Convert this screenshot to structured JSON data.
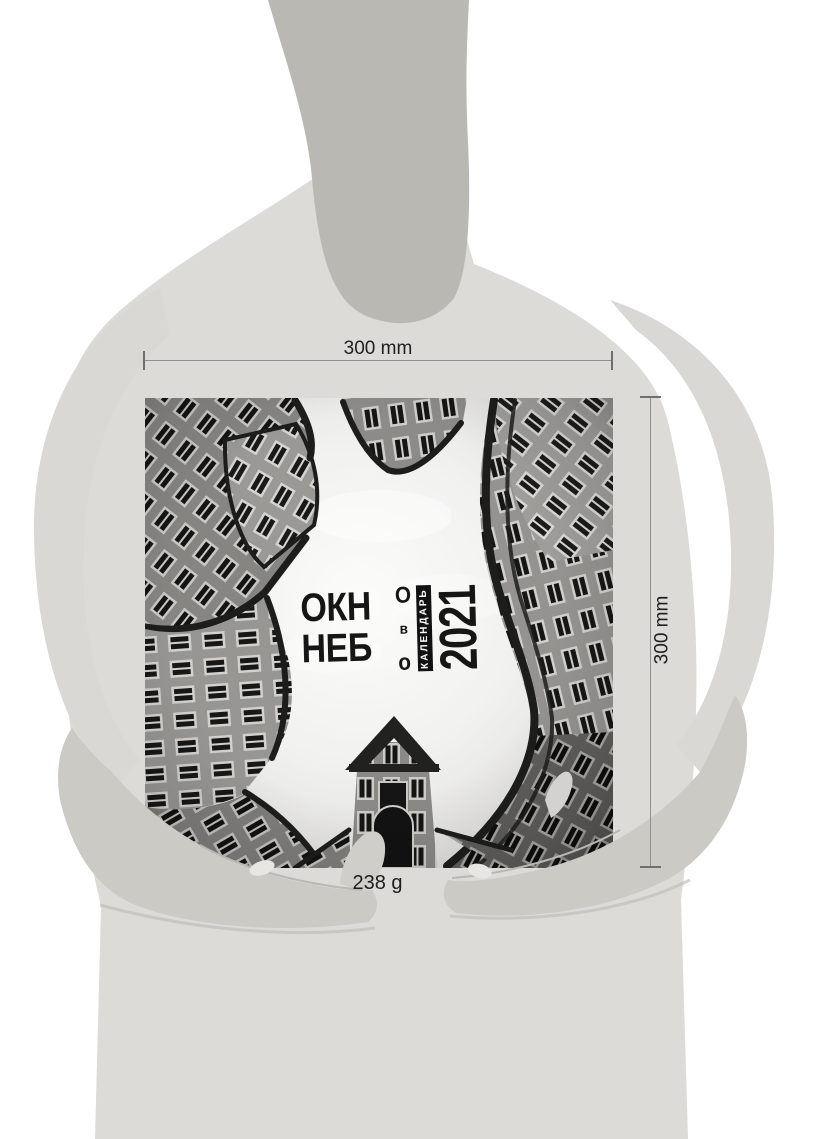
{
  "annotations": {
    "width_label": "300 mm",
    "height_label": "300 mm",
    "weight_label": "238 g"
  },
  "cover": {
    "word1": "ОКН",
    "word1_final": "О",
    "preposition": "в",
    "word2": "НЕБ",
    "word2_final": "о",
    "subtitle": "КАЛЕНДАРЬ",
    "year": "2021"
  },
  "colors": {
    "background": "#ffffff",
    "silhouette_body": "#dcdbd8",
    "silhouette_neck": "#b9b8b2",
    "silhouette_hands": "#cbcac5",
    "dimension_line": "#8f8f8f",
    "annotation_text": "#1f1f1f",
    "cover_strip": "#111111",
    "cover_text": "#161616"
  }
}
